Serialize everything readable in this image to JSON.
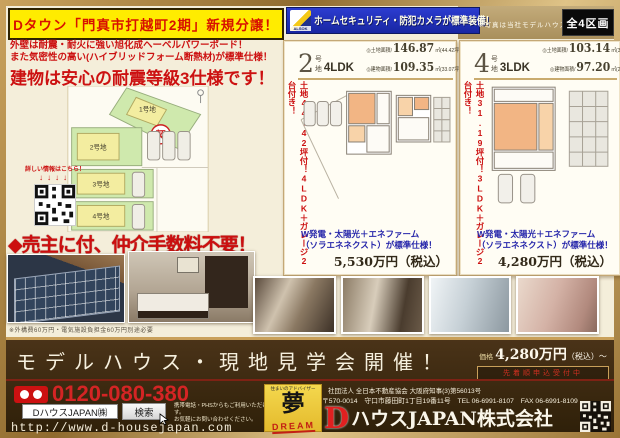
{
  "colors": {
    "accent_red": "#cc1111",
    "banner_yellow": "#ffec00",
    "security_blue": "#2030b8",
    "frame_gold": "#c9a05a",
    "banner_brown": "#3b2a12"
  },
  "page": {
    "top": {
      "title_banner": "Dタウン「門真市打越町2期」新規分譲！",
      "alsok_logo": "ALSOK",
      "security_banner": "ホームセキュリティ・防犯カメラが標準装備！",
      "model_note": "※写真は当社モデルハウスです",
      "lots_badge": "全4区画"
    },
    "left": {
      "feature_line1": "外壁は耐震・耐火に強い旭化成ヘーベルパワーボード！",
      "feature_line2": "また気密性の高い(ハイブリッドフォーム断熱材)が標準仕様！",
      "headline": "建物は安心の耐震等級3仕様です！",
      "qr_caption": "詳しい情報はこちら！",
      "qr_arrows": "↓↓↓↓",
      "site_map": {
        "lot1_label": "1号地",
        "lot1_status": "契",
        "lot2_label": "2号地",
        "lot3_label": "3号地",
        "lot4_label": "4号地"
      },
      "no_fee_headline": "◆売主に付、仲介手数料不要！",
      "photo_caption": "※外構費60万円・電気施設負担金60万円別途必要"
    },
    "properties": [
      {
        "lot_no": "2",
        "lot_unit": "号地",
        "layout": "4LDK",
        "land_label": "◎土地面積/",
        "land_value": "146.87",
        "land_tsubo": "㎡(44.42坪)",
        "bldg_label": "◎建物面積/",
        "bldg_value": "109.35",
        "bldg_tsubo": "㎡(33.07坪)",
        "side_note": "土地44.42坪付！4LDK＋ガレージ2台付き！",
        "equip_line1": "W発電・太陽光＋エネファーム",
        "equip_line2": "（ソラエネネクスト）が標準仕様！",
        "price": "5,530万円（税込）"
      },
      {
        "lot_no": "4",
        "lot_unit": "号地",
        "layout": "3LDK",
        "land_label": "◎土地面積/",
        "land_value": "103.14",
        "land_tsubo": "㎡(31.19坪)",
        "bldg_label": "◎建物面積/",
        "bldg_value": "97.20",
        "bldg_tsubo": "㎡(29.40坪)",
        "side_note": "土地31.19坪付！3LDK＋ガレージ2台付き！",
        "equip_line1": "W発電・太陽光＋エネファーム",
        "equip_line2": "（ソラエネネクスト）が標準仕様！",
        "price": "4,280万円（税込）"
      }
    ],
    "event": {
      "headline": "モデルハウス・現地見学会開催！",
      "price_label": "価格",
      "price_main": "4,280万円",
      "price_tail": "（税込）〜",
      "price_sub": "先着順申込受付中"
    },
    "footer": {
      "freephone": "0120-080-380",
      "search_value": "DハウスJAPAN㈱",
      "search_button": "検索",
      "contact_note1": "携帯電話・PHSからもご利用いただけます。",
      "contact_note2": "お気軽にお問い合わせください。",
      "url": "http://www.d-housejapan.com",
      "dream": {
        "tagline": "住まいのアドバイザー",
        "kanji": "夢",
        "roman": "DREAM"
      },
      "association": "社団法人 全日本不動産協会 大阪府知事(3)第56013号",
      "address": "〒570-0014　守口市藤田町1丁目19番11号　TEL 06-6991-8107　FAX 06-6991-8109",
      "company_initial": "D",
      "company_name": "ハウスJAPAN株式会社"
    }
  }
}
